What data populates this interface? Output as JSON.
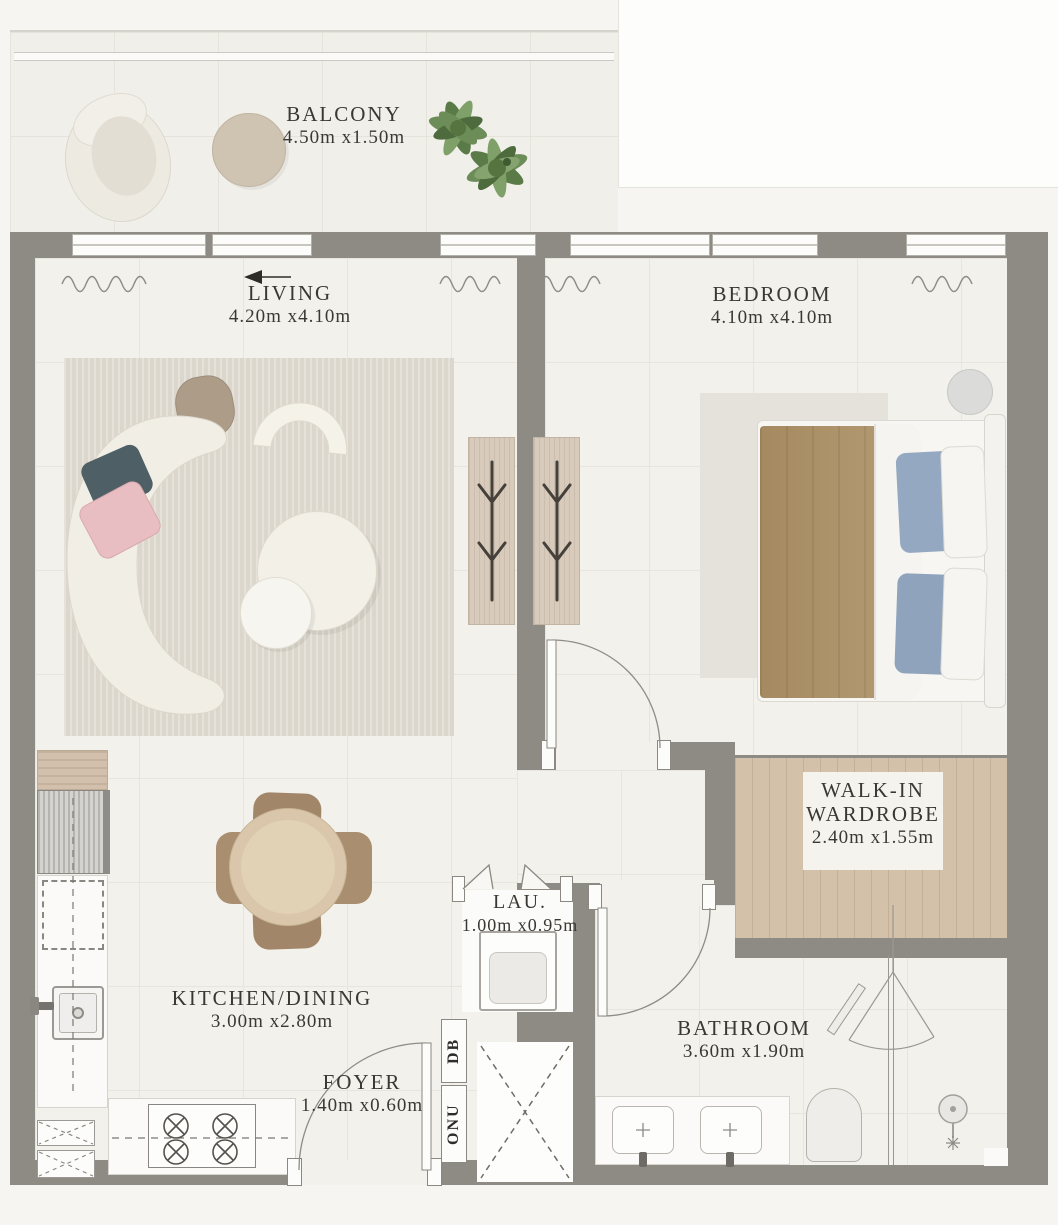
{
  "plan": {
    "type": "apartment-floor-plan",
    "rooms": [
      {
        "name": "BALCONY",
        "dims": "4.50m x1.50m"
      },
      {
        "name": "LIVING",
        "dims": "4.20m x4.10m"
      },
      {
        "name": "BEDROOM",
        "dims": "4.10m x4.10m"
      },
      {
        "name": "WALK-IN WARDROBE",
        "dims": "2.40m x1.55m"
      },
      {
        "name": "LAU.",
        "dims": "1.00m x0.95m"
      },
      {
        "name": "KITCHEN/DINING",
        "dims": "3.00m x2.80m"
      },
      {
        "name": "FOYER",
        "dims": "1.40m x0.60m"
      },
      {
        "name": "BATHROOM",
        "dims": "3.60m x1.90m"
      }
    ],
    "utility": {
      "db": "DB",
      "onu": "ONU"
    },
    "palette": {
      "wall": "#8e8b85",
      "floor": "#f3f1eb",
      "wood_floor": "#d3c1aa",
      "living_rug": "#dcd7cd",
      "sofa": "#f1eee5",
      "pillow_teal": "#4e5f66",
      "pillow_pink": "#e9bec2",
      "blanket_tan": "#ab9067",
      "pillow_blue": "#94a8c1",
      "dining_table": "#dac7ab",
      "dining_chair": "#a1866a",
      "plant_green": "#6d8d58",
      "label_text": "#3a3833"
    }
  }
}
